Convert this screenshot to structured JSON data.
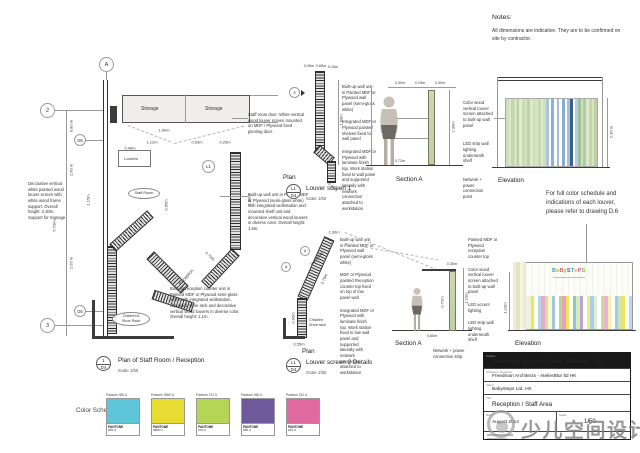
{
  "notes": {
    "title": "Notes:",
    "line1": "All dimensions are indicative. They are to be confirmed on",
    "line2": "site by contractor."
  },
  "color_note": {
    "line1": "For full color schedule and",
    "line2": "indications of each louver,",
    "line3": "please refer to drawing D.6"
  },
  "plan_main": {
    "grid_a": "A",
    "grid_2": "2",
    "grid_d6": "D6",
    "grid_d5": "D5",
    "grid_3": "3",
    "tag_l1": "L1",
    "storage1": "Storage",
    "storage2": "Storage",
    "lockers": "Lockers",
    "staff_room": "Staff Room",
    "reception": "Reception",
    "shoe_rack_1": "Children's",
    "shoe_rack_2": "Shoe Rack",
    "dims": {
      "d080": "0.80 m",
      "d160": "1.60 m",
      "d265": "2.65 m",
      "d670": "6.70m",
      "d115": "1.15m",
      "w160": "1.60m",
      "w112": "1.12m",
      "w040": "0.40m",
      "w063": "0.63m",
      "w025": "0.25m",
      "h130": "1.30m",
      "g073": "0.73m",
      "g065": "0.65m"
    },
    "ann_louver": "Decorative vertical white painted wood louver screen with white wood frame support. Overall height: 2.30m. Support for Signage.",
    "ann_door": "Staff room door: White vertical wood louver screen mounted on MDF / Plywood fixed pivoting door.",
    "ann_wall": "Built-up wall unit in Painted MDF or Plywood (semi-gloss white) with integrated workstation and mounted shelf unit and decorative vertical wood louvers in diverse color. Overall height: 1.5m.",
    "ann_counter": "Built-up reception counter unit in Painted MDF or Plywood semi-gloss white with integrated workstation, clipboard, shoe rack and decorative vertical wood louvers in diverse color. Overall height: 1.1m.",
    "title_num": "1",
    "title_sheet": "D4",
    "title_text": "Plan of Staff Room / Reception",
    "title_scale": "Scale 1/50"
  },
  "louver1": {
    "marker": "A",
    "plan_label": "Plan",
    "section_label": "Section A",
    "elevation_label": "Elevation",
    "dims": {
      "t1": "0.05m",
      "t2": "0.65m",
      "t3": "0.15m",
      "r1": "1.60m",
      "b1": "0.65m",
      "s1": "0.30m",
      "s2": "0.15m",
      "s3": "0.30m",
      "s4": "2.30m",
      "s5": "0.72m",
      "e1": "2.30 m"
    },
    "ann_left": [
      "Built-up wall unit in Painted MDF or Plywood wall panel (semi-gloss white)",
      "Integrated MDF or Plywood painted shelves fixed to wall panel",
      "Integrated MDF or Plywood with laminate finish top. Work station fixed to wall panel and supported laterally with network connection attached to workstation"
    ],
    "ann_right": [
      "Color wood vertical louver screen attached to built-up wall panel",
      "LED strip wall lighting underneath shelf",
      "Network + power connection point"
    ],
    "title_num": "L1",
    "title_sheet": "D4",
    "title_text": "Louver screen 1",
    "title_scale": "Scale 1/50",
    "stripes": [
      "#cfe0bd",
      "#dde9cc",
      "#c2d7ab",
      "#d6e4c2",
      "#bad1a3",
      "#e1ecd2",
      "#c9dcb4",
      "#d2e2bf",
      "#bed4a8",
      "#dbe8ca",
      "#ccdeb6",
      "#d7e5c4",
      "#c4d9ae",
      "#dfead0",
      "#cfe0bd",
      "#aac3df",
      "#ffffff",
      "#8fb0d3",
      "#ffffff",
      "#9ebddb",
      "#ffffff",
      "#88abd0",
      "#ffffff",
      "#a4c0dd",
      "#3d5e92",
      "#ffffff",
      "#b7cde4",
      "#9cc29a",
      "#cfe0bd",
      "#b0cb9c",
      "#dde9cc",
      "#c2d7ab",
      "#d6e4c2",
      "#bad1a3"
    ]
  },
  "louver2": {
    "marker1": "A",
    "marker2": "A",
    "plan_label": "Plan",
    "section_label": "Section A",
    "elevation_label": "Elevation",
    "reception": "Reception",
    "shoe_rack_1": "Children",
    "shoe_rack_2": "Shoe rack",
    "dims": {
      "p1": "1.30m",
      "p2": "2.70m",
      "p3": "0.90m",
      "p4": "0.55m",
      "s1": "0.72m",
      "s2": "1.10m",
      "s3": "0.30m",
      "s4": "0.60m",
      "e1": "1.10m"
    },
    "ann_left": [
      "Built-up wall unit in Painted MDF or Plywood wall panel (semi-gloss white)",
      "MDF or Plywood painted Reception counter top fixed on top of low panel wall",
      "Integrated MDF or Plywood with laminate finish top. Work station fixed to low wall panel and supported laterally with network connection attached to workstation"
    ],
    "ann_right": [
      "Painted MDF or Plywood reception counter top",
      "Color wood vertical louver screen attached to built-up wall panel",
      "LED accent lighting",
      "LED strip wall lighting underneath shelf"
    ],
    "ann_network": "Network + power connection strip",
    "title_num": "L1",
    "title_sheet": "D4",
    "title_text": "Louver screen 2 Details",
    "title_scale": "Scale 1/50",
    "logo": [
      {
        "ch": "B",
        "c": "#3f9ec4"
      },
      {
        "ch": "a",
        "c": "#e6b52c"
      },
      {
        "ch": "B",
        "c": "#cf5f92"
      },
      {
        "ch": "y",
        "c": "#86bb42"
      },
      {
        "ch": "S",
        "c": "#6f57a0"
      },
      {
        "ch": "T",
        "c": "#3f9ec4"
      },
      {
        "ch": "e",
        "c": "#e6b52c"
      },
      {
        "ch": "P",
        "c": "#cf5f92"
      },
      {
        "ch": "S",
        "c": "#86bb42"
      }
    ],
    "left_stripes": [
      "#f1ecd2",
      "#dde7c4",
      "#f8f4e2",
      "#e6edd2"
    ],
    "stripes": [
      "#eef2da",
      "#f0e655",
      "#ffffff",
      "#b5d4e8",
      "#e9a8c6",
      "#c8e0b2",
      "#fdf6c9",
      "#9ec7e2",
      "#ffffff",
      "#b8d593",
      "#e79fc2",
      "#f0e655",
      "#ffffff",
      "#8fc6c0",
      "#d9e8c4",
      "#b9a6d0",
      "#ffffff",
      "#f2eb8a",
      "#aacfe6",
      "#e2eed2",
      "#ffffff",
      "#c4dca5",
      "#edb3cc",
      "#f5efae",
      "#ffffff",
      "#a3cbe4",
      "#cde3b8",
      "#f0e655",
      "#ffffff",
      "#bcd8ea"
    ]
  },
  "color_schedule": {
    "label": "Color Schedule",
    "swatches": [
      {
        "name": "Pantone 305 U",
        "brand": "PANTONE",
        "code": "305 U",
        "color": "#5ec6d8"
      },
      {
        "name": "Pantone 3965 U",
        "brand": "PANTONE",
        "code": "3965 U",
        "color": "#e8dc33"
      },
      {
        "name": "Pantone 374 U",
        "brand": "PANTONE",
        "code": "374 U",
        "color": "#b5d554"
      },
      {
        "name": "Pantone 265 U",
        "brand": "PANTONE",
        "code": "265 U",
        "color": "#6f5a9c"
      },
      {
        "name": "Pantone 231 U",
        "brand": "PANTONE",
        "code": "231 U",
        "color": "#e0699f"
      }
    ]
  },
  "titleblock": {
    "project_label": "Project",
    "project": "Babysteps Interior Fitouts, Midlevels , HK",
    "architect_label": "Architect / Designer",
    "architect": "Freedman Architects - AtelierBlur ltd HK",
    "client_label": "Client",
    "client": "Babysteps Ltd. HK",
    "title_label": "Title",
    "title": "Reception / Staff Area",
    "date_label": "Date",
    "date": "August 2014",
    "scale_label": "Scale",
    "scale": "1/50"
  },
  "watermark": "少儿空间设计"
}
